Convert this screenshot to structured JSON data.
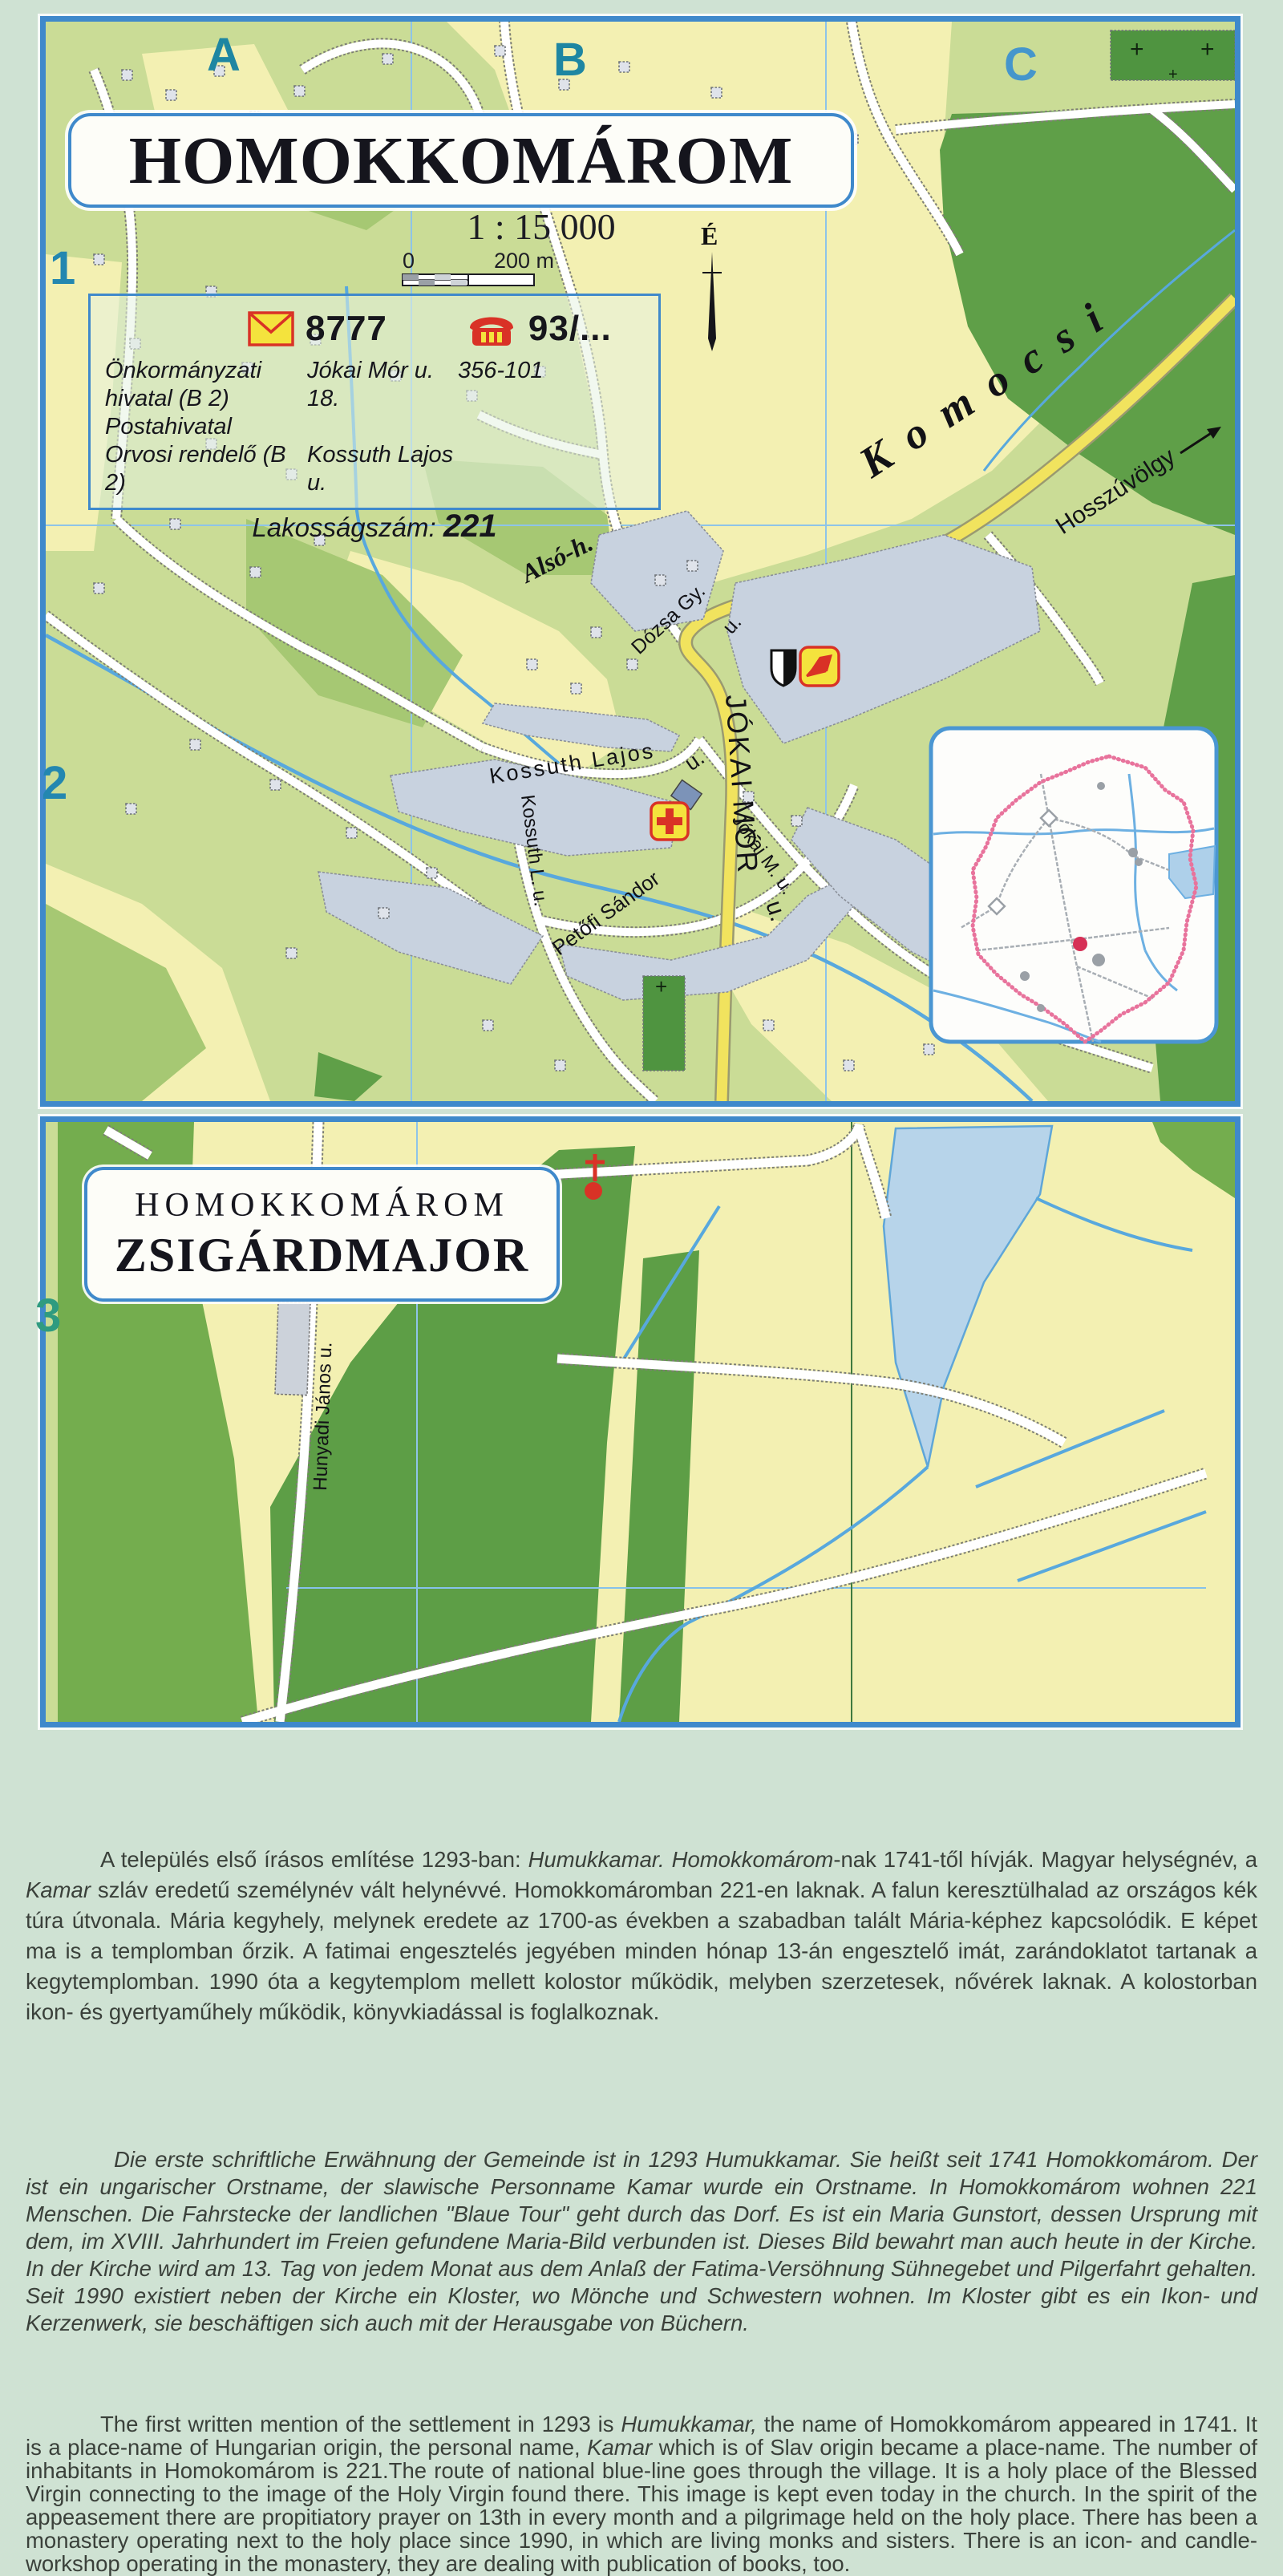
{
  "map1": {
    "title": "HOMOKKOMÁROM",
    "grid_cols": [
      "A",
      "B",
      "C"
    ],
    "grid_rows": [
      "1",
      "2"
    ],
    "scale": {
      "ratio": "1 : 15 000",
      "zero": "0",
      "end": "200 m"
    },
    "north": "É",
    "info": {
      "postal_code": "8777",
      "phone_code": "93/...",
      "rows": [
        [
          "Önkormányzati hivatal (B 2)",
          "Jókai Mór u. 18.",
          "356-101"
        ],
        [
          "Postahivatal",
          "",
          ""
        ],
        [
          "Orvosi rendelő (B 2)",
          "Kossuth Lajos u.",
          ""
        ]
      ],
      "population_label": "Lakosságszám:",
      "population": "221"
    },
    "labels": {
      "komocsi": "Komocsi",
      "hosszuvolgy": "Hosszúvölgy",
      "also": "Alsó-h.",
      "dozsa": "Dózsa Gy.",
      "dozsa_u": "u.",
      "jokai_mor": "JÓKAI MÓR",
      "jokai_mor_u": "u.",
      "kossuth_lajos": "Kossuth Lajos",
      "kossuth_lajos_u": "u.",
      "kossuth_l": "Kossuth L. u.",
      "petofi": "Petőfi Sándor",
      "jokai_m": "Jókai M. u."
    }
  },
  "map2": {
    "grid_row": "3",
    "title_line1": "HOMOKKOMÁROM",
    "title_line2": "ZSIGÁRDMAJOR",
    "street": "Hunyadi János u."
  },
  "texts": {
    "hu": {
      "segments": [
        {
          "t": "A település első írásos említése 1293-ban: ",
          "i": false
        },
        {
          "t": "Humukkamar. Homokkomárom",
          "i": true
        },
        {
          "t": "-nak 1741-től hívják. Magyar helységnév, a ",
          "i": false
        },
        {
          "t": "Kamar",
          "i": true
        },
        {
          "t": " szláv eredetű személynév vált helynévvé. Homokkomáromban 221-en laknak. A falun keresztülhalad az országos kék túra útvonala. Mária kegyhely, melynek eredete az 1700-as években a szabadban talált Mária-képhez kapcsolódik. E képet ma is a templomban őrzik. A fatimai engesztelés jegyében minden hónap 13-án engesztelő imát, zarándoklatot tartanak a kegytemplomban. 1990 óta a kegytemplom mellett kolostor működik, melyben szerzetesek, nővérek laknak. A kolostorban ikon- és gyertyaműhely működik, könyvkiadással is foglalkoznak.",
          "i": false
        }
      ]
    },
    "de": {
      "segments": [
        {
          "t": "Die erste schriftliche Erwähnung der Gemeinde ist in 1293 Humukkamar. Sie heißt seit 1741 Homokkomárom. Der ist ein ungarischer Orstname, der slawische Personname Kamar wurde ein Orstname. In Homokkomárom wohnen 221 Menschen. Die Fahrstecke der landlichen \"Blaue Tour\" geht durch das Dorf. Es ist ein Maria Gunstort, dessen Ursprung mit dem, im XVIII. Jahrhundert im Freien gefundene Maria-Bild verbunden ist. Dieses Bild bewahrt man auch heute in der Kirche. In der Kirche wird am 13. Tag von jedem Monat aus dem Anlaß der Fatima-Versöhnung Sühnegebet und Pilgerfahrt gehalten. Seit 1990 existiert neben der Kirche ein Kloster, wo Mönche und Schwestern wohnen. Im Kloster gibt es ein Ikon- und Kerzenwerk, sie beschäftigen sich auch mit der Herausgabe von Büchern.",
          "i": true
        }
      ]
    },
    "en": {
      "segments": [
        {
          "t": "The first written mention of the settlement in 1293 is ",
          "i": false
        },
        {
          "t": "Humukkamar,",
          "i": true
        },
        {
          "t": " the name of Homokkomárom appeared in 1741. It is a place-name of Hungarian origin, the personal name, ",
          "i": false
        },
        {
          "t": "Kamar",
          "i": true
        },
        {
          "t": " which is of Slav origin became a place-name. The number of inhabitants in Homokomárom is 221.The route of national blue-line goes through the village. It is a holy place of the Blessed Virgin connecting to the image of the Holy Virgin found there. This image is kept even today in the church. In the spirit of the appeasement there are propitiatory prayer on 13th in every month and a pilgrimage held on the holy place. There has been a monastery operating next to the holy place since 1990, in which are living monks and sisters. There is an icon- and candle-workshop operating in the monastery, they are dealing with publication of books, too.",
          "i": false
        }
      ]
    }
  },
  "colors": {
    "accent": "#3f89cb",
    "teal": "#1e86a2",
    "gridblue": "#4596cc",
    "rowteal": "#2f9b80",
    "field": "#cadc96",
    "paleyellow": "#f3f0b2",
    "forest": "#5f9f48",
    "midgreen": "#a6c873",
    "roadyellow": "#f1e35e",
    "stream": "#58a8dd",
    "builtup": "#c8d2df",
    "lake": "#b7d4ea",
    "red": "#d93226",
    "iconyellow": "#f4e33d",
    "pink": "#e8739c",
    "pagebg": "#cfe2d3",
    "ink": "#3a403a"
  }
}
